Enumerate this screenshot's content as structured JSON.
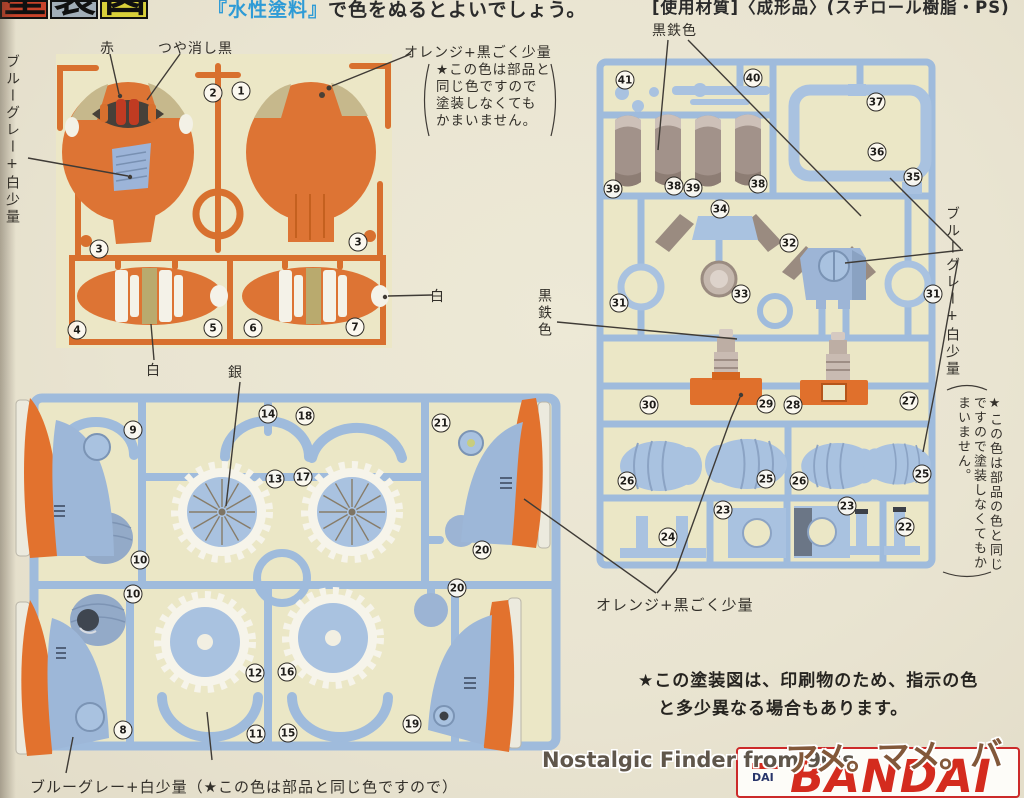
{
  "header": {
    "title_tiles": [
      "塗",
      "装",
      "図"
    ],
    "paint_note": {
      "open": "『",
      "paint_name": "水性塗料",
      "close": "』",
      "rest": "で色をぬるとよいでしょう。"
    },
    "material_note": "[使用材質]〈成形品〉(スチロール樹脂・PS)"
  },
  "callouts": {
    "red": "赤",
    "matte_black": "つや消し黒",
    "blue_gray_white_left": "ブルーグレー+白少量",
    "orange_black_top": "オレンジ+黒ごく少量",
    "orange_black_top_note": [
      "★この色は部品と",
      "同じ色ですので",
      "塗装しなくても",
      "かまいません。"
    ],
    "iron_black_top": "黒鉄色",
    "iron_black_mid": "黒鉄色",
    "blue_gray_white_right": "ブルーグレー+白少量",
    "blue_gray_white_right_note": "★この色は部品の色と同じですので塗装しなくてもかまいません。",
    "white_stripe": "白",
    "white_nose": "白",
    "silver": "銀",
    "orange_black_bottom": "オレンジ+黒ごく少量",
    "blue_gray_white_bottom": "ブルーグレー+白少量（★この色は部品と同じ色ですので）"
  },
  "footer": {
    "print_note_line1": "★この塗装図は、印刷物のため、指示の色",
    "print_note_line2": "と多少異なる場合もあります。"
  },
  "watermark": {
    "text": "Nostalgic Finder from 90's",
    "logo": "アメ。マメ。バー",
    "brand": "BANDAI",
    "brand_small": "DAI"
  },
  "sprues": {
    "orange_runner": {
      "badges": [
        {
          "n": "2",
          "x": 213,
          "y": 93
        },
        {
          "n": "1",
          "x": 241,
          "y": 91
        },
        {
          "n": "3",
          "x": 99,
          "y": 249
        },
        {
          "n": "3",
          "x": 358,
          "y": 242
        },
        {
          "n": "4",
          "x": 77,
          "y": 330
        },
        {
          "n": "5",
          "x": 213,
          "y": 328
        },
        {
          "n": "6",
          "x": 253,
          "y": 328
        },
        {
          "n": "7",
          "x": 355,
          "y": 327
        }
      ]
    },
    "left_blue_runner": {
      "badges": [
        {
          "n": "9",
          "x": 133,
          "y": 430
        },
        {
          "n": "14",
          "x": 268,
          "y": 414
        },
        {
          "n": "18",
          "x": 305,
          "y": 416
        },
        {
          "n": "21",
          "x": 441,
          "y": 423
        },
        {
          "n": "13",
          "x": 275,
          "y": 479
        },
        {
          "n": "17",
          "x": 303,
          "y": 477
        },
        {
          "n": "10",
          "x": 140,
          "y": 560
        },
        {
          "n": "10",
          "x": 133,
          "y": 594
        },
        {
          "n": "20",
          "x": 482,
          "y": 550
        },
        {
          "n": "20",
          "x": 457,
          "y": 588
        },
        {
          "n": "12",
          "x": 255,
          "y": 673
        },
        {
          "n": "16",
          "x": 287,
          "y": 672
        },
        {
          "n": "11",
          "x": 256,
          "y": 734
        },
        {
          "n": "15",
          "x": 288,
          "y": 733
        },
        {
          "n": "19",
          "x": 412,
          "y": 724
        },
        {
          "n": "8",
          "x": 123,
          "y": 730
        }
      ]
    },
    "right_blue_runner": {
      "badges": [
        {
          "n": "41",
          "x": 625,
          "y": 80
        },
        {
          "n": "40",
          "x": 753,
          "y": 78
        },
        {
          "n": "37",
          "x": 876,
          "y": 102
        },
        {
          "n": "36",
          "x": 877,
          "y": 152
        },
        {
          "n": "35",
          "x": 913,
          "y": 177
        },
        {
          "n": "39",
          "x": 613,
          "y": 189
        },
        {
          "n": "38",
          "x": 674,
          "y": 186
        },
        {
          "n": "39",
          "x": 693,
          "y": 188
        },
        {
          "n": "38",
          "x": 758,
          "y": 184
        },
        {
          "n": "34",
          "x": 720,
          "y": 209
        },
        {
          "n": "32",
          "x": 789,
          "y": 243
        },
        {
          "n": "33",
          "x": 741,
          "y": 294
        },
        {
          "n": "31",
          "x": 619,
          "y": 303
        },
        {
          "n": "31",
          "x": 933,
          "y": 294
        },
        {
          "n": "30",
          "x": 649,
          "y": 405
        },
        {
          "n": "29",
          "x": 766,
          "y": 404
        },
        {
          "n": "28",
          "x": 793,
          "y": 405
        },
        {
          "n": "27",
          "x": 909,
          "y": 401
        },
        {
          "n": "26",
          "x": 627,
          "y": 481
        },
        {
          "n": "25",
          "x": 766,
          "y": 479
        },
        {
          "n": "26",
          "x": 799,
          "y": 481
        },
        {
          "n": "25",
          "x": 922,
          "y": 474
        },
        {
          "n": "24",
          "x": 668,
          "y": 537
        },
        {
          "n": "23",
          "x": 723,
          "y": 510
        },
        {
          "n": "23",
          "x": 847,
          "y": 506
        },
        {
          "n": "22",
          "x": 905,
          "y": 527
        }
      ]
    }
  },
  "colors": {
    "page_bg": "#e9e4d1",
    "sprue_bg": "#ebe7c6",
    "orange_plastic": "#dd7434",
    "orange_runner": "#d8702e",
    "blue_plastic": "#a9c2e0",
    "blue_runner": "#9fbbdc",
    "gunmetal": "#9a8b80",
    "red_lens": "#c03b22",
    "matte_black_band": "#474039",
    "khaki": "#c6b88c",
    "silver_line": "#8d8170",
    "bandai_red": "#d42b1e",
    "paint_name_blue": "#2e9bd6",
    "title_tile_bgs": [
      "#c8432a",
      "#a2aeb8",
      "#d8cf3a"
    ]
  }
}
